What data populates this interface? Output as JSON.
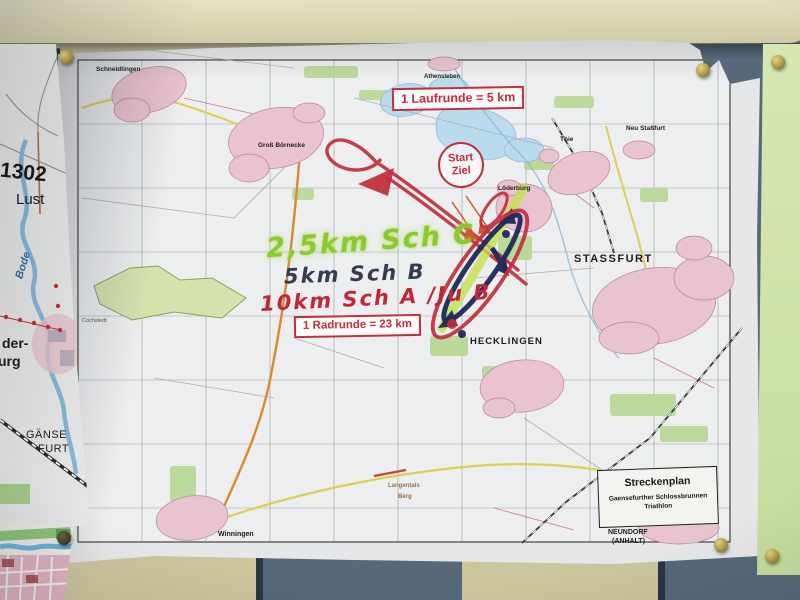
{
  "map_sheet": {
    "run_lap_label": "1 Laufrunde = 5 km",
    "bike_lap_label": "1 Radrunde = 23 km",
    "start_finish": {
      "line1": "Start",
      "line2": "Ziel"
    },
    "handwritten": {
      "school_c": "2,5km Sch C",
      "school_b": "5km Sch B",
      "school_a_youth_b": "10km Sch A /Ju B"
    },
    "legend": {
      "title": "Streckenplan",
      "subtitle_line1": "Gaensefurther Schlossbrunnen",
      "subtitle_line2": "Triathlon"
    },
    "towns": {
      "schneidlingen": "Schneidlingen",
      "gross_boernecke": "Groß Börnecke",
      "athensleben": "Athensleben",
      "neu_stassfurt": "Neu Staßfurt",
      "thie": "Thie",
      "loederburg": "Löderburg",
      "stassfurt": "STASSFURT",
      "hecklingen": "HECKLINGEN",
      "cochstedt": "Cochstedt",
      "winningen": "Winningen",
      "langentals": "Langentals",
      "berg": "Berg",
      "neundorf": "NEUNDORF",
      "anhalt": "(ANHALT)"
    }
  },
  "left_sheet": {
    "road_number": "1302",
    "lust": "Lust",
    "bode": "Bode",
    "fragment_der": "der-",
    "fragment_urg": "urg",
    "gaense": "GÄNSE",
    "furt": "FURT"
  },
  "colors": {
    "route_red": "#c0303c",
    "route_navy": "#1f2a5a",
    "route_highlight_green": "#c6e050",
    "handwriting_green": "#8cc832",
    "handwriting_dark": "#343c50",
    "handwriting_red": "#c02838",
    "board_blue": "#56687a",
    "board_beige": "#d0caa0",
    "note_paper_green": "#cfe3ab",
    "pin_brass": "#c9b05c"
  }
}
